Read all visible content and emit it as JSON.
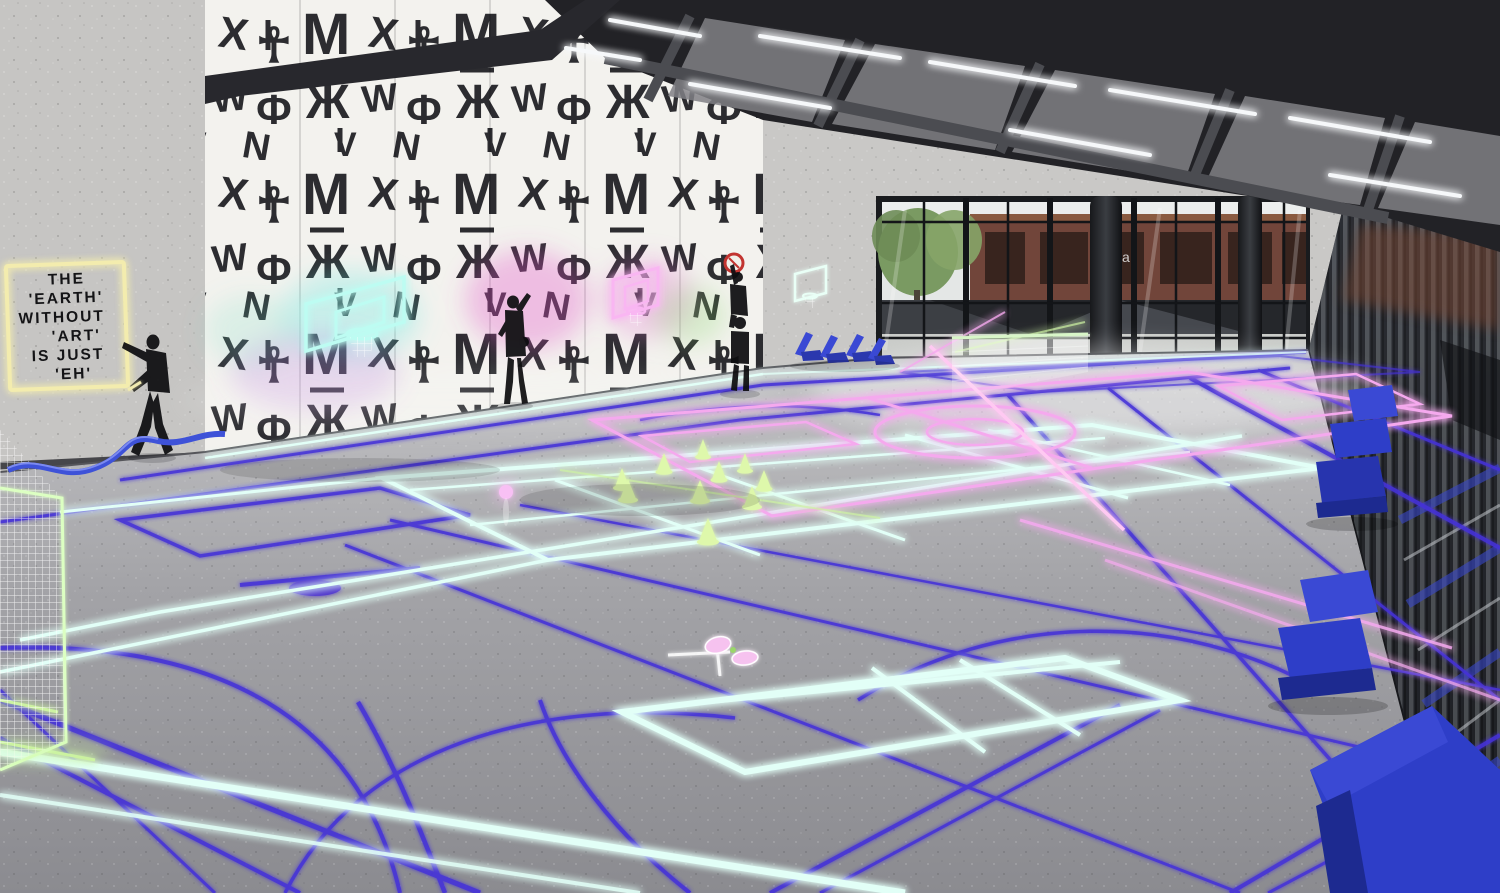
{
  "scene": {
    "type": "architectural-3d-render",
    "setting": "indoor multi-sport gymnasium with neon-glow projected court lines, calligraffiti mural wall, stencil street-art figures, glass curtain wall and blue sculptural seating",
    "quote_sign": {
      "lines": [
        "THE",
        "'EARTH'",
        "WITHOUT",
        "'ART'",
        "IS JUST",
        "'EH'"
      ],
      "frame_color": "#f3ecae",
      "text_color": "#141416"
    },
    "window_reflection_letter": "a",
    "mural": {
      "style": "black calligraffiti glyphs on white panels",
      "glyphs": [
        "M",
        "X",
        "W",
        "Ж",
        "☥",
        "Ф",
        "V",
        "N"
      ]
    },
    "palette": {
      "floor_far": "#c4c4c6",
      "floor_near": "#8b8b90",
      "wall_grey": "#c6c5c3",
      "mural_bg": "#f3f2ee",
      "mural_glyph": "#1b1b1f",
      "ceiling_dark": "#222226",
      "ceiling_panel": "#808085",
      "led_white": "#f6f8fa",
      "line_indigo": "#4531d8",
      "line_cyan": "#e2fff7",
      "line_pink": "#f5a9ee",
      "line_green": "#cdf2a2",
      "cone_green": "#def8ab",
      "neon_yellow": "#f3ecae",
      "seat_blue": "#3a49d4",
      "bench_blue": "#2e3ec8",
      "ribbon_blue": "#3e52d8",
      "window_frame": "#15171a",
      "building_brown": "#71453a",
      "tree_green": "#7a9a62",
      "glass_light": "#e4e7e6",
      "right_wall_dark": "#26282d",
      "red_sign": "#c23430",
      "ball_pink": "#f8c0f4",
      "figure_black": "#0d0d10"
    },
    "objects": {
      "stencil_artworks": [
        {
          "label": "figure hanging a glowing frame around the quote"
        },
        {
          "label": "figure painting at the mural wall"
        },
        {
          "label": "two stacked figures raising a round red sign"
        }
      ],
      "basketball_backboards": [
        {
          "color_name": "cyan",
          "hex": "#bdfcf2"
        },
        {
          "color_name": "pink",
          "hex": "#f9b6f2"
        },
        {
          "color_name": "mint-white",
          "hex": "#e9fff6"
        }
      ],
      "training_cones": {
        "count": 10,
        "color": "#def8ab"
      },
      "badminton_rackets": {
        "count": 2,
        "color": "#f6c2ef"
      },
      "glowing_ball": {
        "count": 1,
        "color": "#f8c0f4"
      },
      "goal_net": {
        "count": 1,
        "frame_color": "#dcffc2",
        "net_color": "#ffffff"
      },
      "training_net": {
        "count": 1,
        "post_color": "#fce9f2",
        "top_band_color": "#d8f6c8"
      },
      "lounge_chairs": {
        "count": 4,
        "color": "#3a49d4"
      },
      "benches": {
        "count": 3,
        "color": "#2e3ec8"
      },
      "floor_ribbon": {
        "count": 1,
        "color": "#3e52d8"
      }
    }
  }
}
